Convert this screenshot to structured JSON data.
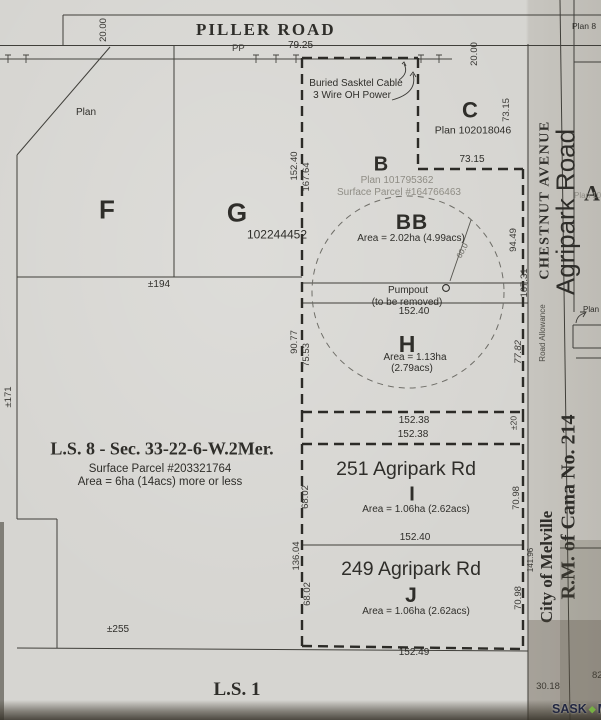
{
  "colors": {
    "paper": "#d6d5d1",
    "ink": "#2f2e2a",
    "faint_ink": "#8f8d85",
    "logo_navy": "#222741",
    "logo_green": "#76b043"
  },
  "road": {
    "name": "PILLER ROAD",
    "width_left": "20.00",
    "width_right": "20.00",
    "pp": "PP",
    "pp_distance": "79.25",
    "cable_note_line1": "Buried Sasktel Cable",
    "cable_note_line2": "3 Wire OH Power"
  },
  "parcels": {
    "f": {
      "letter": "F",
      "plan_note": "Plan"
    },
    "g": {
      "letter": "G",
      "plan_number": "102244452",
      "south_dim": "±194"
    },
    "c": {
      "letter": "C",
      "plan": "Plan 102018046",
      "west_dim": "73.15",
      "south_dim": "73.15"
    },
    "b": {
      "letter": "B",
      "plan": "Plan 101795362",
      "surface_parcel": "Surface Parcel #164766463",
      "west_dim_outer": "152.40",
      "west_dim_inner": "167.64"
    },
    "bb": {
      "letter": "BB",
      "area": "Area = 2.02ha (4.99acs)",
      "east_dim": "94.49",
      "radius_dim": "60.0"
    },
    "h": {
      "letter": "H",
      "area_line1": "Area = 1.13ha",
      "area_line2": "(2.79acs)",
      "west_dim_outer": "90.77",
      "west_dim_inner": "75.53",
      "east_dim": "77.82"
    },
    "i": {
      "address": "251 Agripark Rd",
      "letter": "I",
      "area": "Area = 1.06ha (2.62acs)",
      "west_dim": "68.02",
      "east_dim": "70.98",
      "south_dim": "152.40"
    },
    "j": {
      "address": "249 Agripark Rd",
      "letter": "J",
      "area": "Area = 1.06ha (2.62acs)",
      "west_dim": "68.02",
      "east_dim": "70.98",
      "south_dim": "152.49",
      "west_dim_outer": "136.04",
      "east_dim_outer": "141.96"
    }
  },
  "pumpout": {
    "label": "Pumpout",
    "note": "(to be removed)",
    "south_dim": "152.40",
    "east_dim": "167.31"
  },
  "road_allowance_strip": {
    "north_dim": "152.38",
    "south_dim": "152.38",
    "east_dim": "±20"
  },
  "ls8": {
    "title": "L.S. 8  - Sec. 33-22-6-W.2Mer.",
    "surface_parcel": "Surface Parcel #203321764",
    "area": "Area = 6ha (14acs) more or less",
    "west_dim": "±171",
    "south_dim": "±255"
  },
  "ls1": {
    "title": "L.S. 1"
  },
  "right_margin": {
    "street_1": "CHESTNUT AVENUE",
    "street_2": "Agripark Road",
    "road_allowance": "Road Allowance",
    "municipality_1": "City of Melville",
    "municipality_2": "R.M. of Cana No. 214",
    "plan_top": "Plan 8",
    "adjacent_letter": "A",
    "adjacent_plan": "Plan 10",
    "plan_callout": "Plan",
    "dim_30_18": "30.18",
    "dim_82": "82"
  },
  "watermark": {
    "sask": "SASK",
    "diamond": "◆",
    "mls": "MLS",
    "registered": "®"
  }
}
